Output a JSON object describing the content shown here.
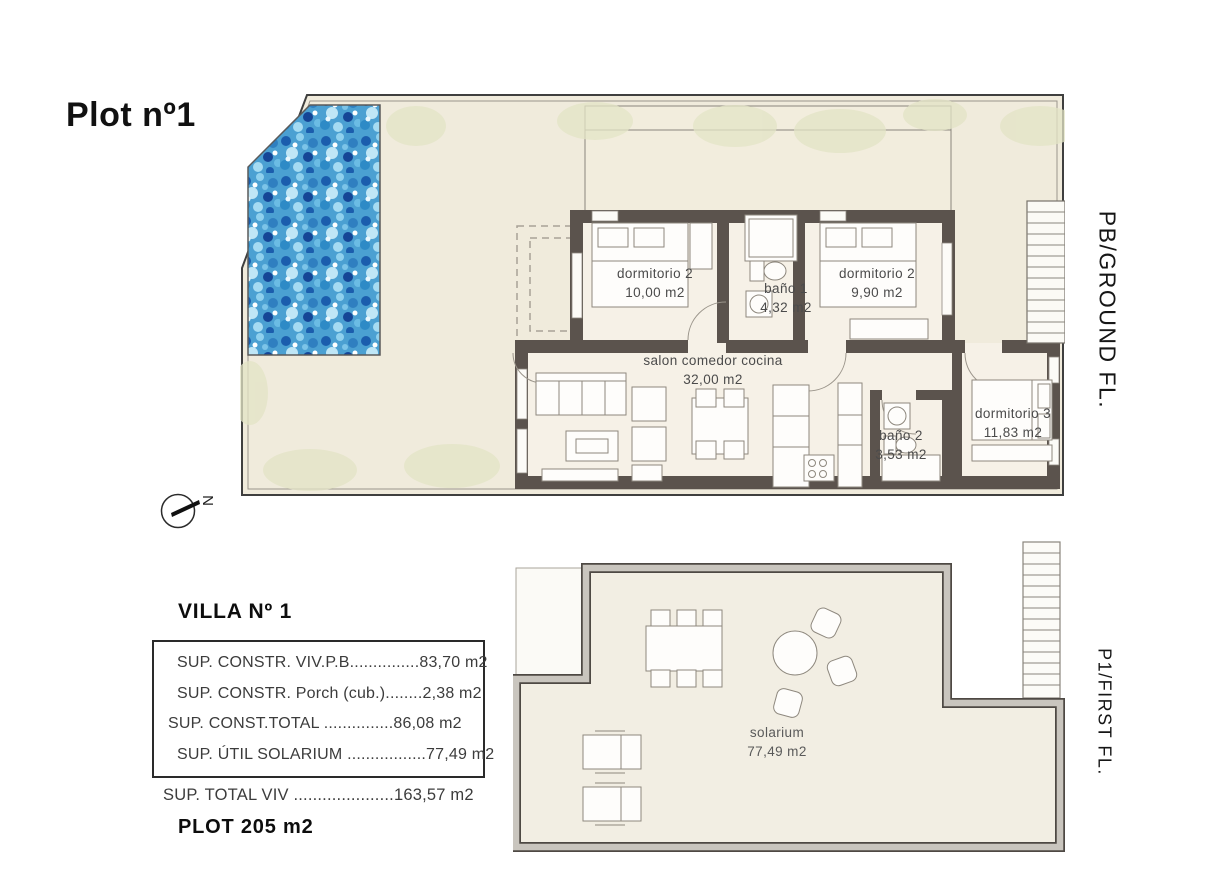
{
  "page": {
    "title": "Plot nº1"
  },
  "floors": {
    "ground_label": "PB/GROUND FL.",
    "first_label": "P1/FIRST FL."
  },
  "compass": {
    "north": "N"
  },
  "ground_floor": {
    "rooms": [
      {
        "name": "dormitorio 2",
        "area": "10,00 m2"
      },
      {
        "name": "baño 1",
        "area": "4,32 m2"
      },
      {
        "name": "dormitorio 2",
        "area": "9,90 m2"
      },
      {
        "name": "salon comedor cocina",
        "area": "32,00 m2"
      },
      {
        "name": "baño 2",
        "area": "3,53 m2"
      },
      {
        "name": "dormitorio 3",
        "area": "11,83 m2"
      }
    ]
  },
  "first_floor": {
    "rooms": [
      {
        "name": "solarium",
        "area": "77,49 m2"
      }
    ]
  },
  "summary": {
    "villa_title": "VILLA Nº 1",
    "rows": [
      "SUP. CONSTR. VIV.P.B...............83,70 m2",
      "SUP. CONSTR. Porch (cub.)........2,38 m2",
      "SUP. CONST.TOTAL ...............86,08 m2",
      "SUP. ÚTIL SOLARIUM .................77,49 m2"
    ],
    "total_row": "SUP. TOTAL VIV .....................163,57 m2",
    "plot_label": "PLOT 205 m2"
  },
  "colors": {
    "wall_dark": "#5b534d",
    "terrace": "#f0ebdc",
    "interior": "#f6f1e7",
    "pool_base": "#4ba0d2",
    "solarium_wall_fill": "#c9c5be",
    "bush": "#e3e4c6"
  }
}
